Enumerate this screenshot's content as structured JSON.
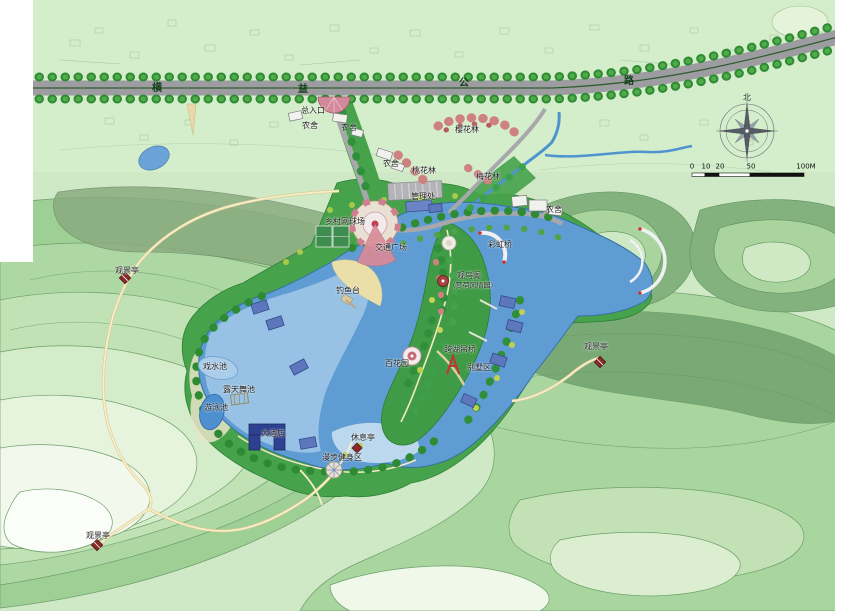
{
  "road": {
    "name_chars": [
      "横",
      "益",
      "公",
      "路"
    ]
  },
  "compass": {
    "north_label": "北"
  },
  "scale_bar": {
    "ticks": [
      "0",
      "10",
      "20",
      "50",
      "100M"
    ]
  },
  "labels": {
    "entrance": "总入口",
    "farmhouse_a": "农舍",
    "farmhouse_b": "农舍",
    "farmhouse_c": "农舍",
    "farmhouse_d": "农舍",
    "cherry_grove": "樱花林",
    "peach_grove": "桃花林",
    "plum_grove": "梅花林",
    "admin_office": "管理处",
    "tennis_court": "乡村网球场",
    "traffic_plaza": "交通广场",
    "rainbow_bridge": "彩虹桥",
    "fishing_platform": "钓鱼台",
    "bird_pavilion": "观鸟阁",
    "bird_pavilion_sub": "（赏荷风情园）",
    "flower_terrace": "百花园",
    "suspension_bridge": "跨湖吊桥",
    "villa_area": "别墅区",
    "viewing_pavilion_w": "观景亭",
    "viewing_pavilion_sw": "观景亭",
    "viewing_pavilion_e": "观景亭",
    "water_play_pool": "戏水池",
    "open_air_dance": "露天舞池",
    "swimming_pool": "游泳池",
    "hotel": "大酒店",
    "rest_pavilion": "休息亭",
    "fitness_trail": "漫步健身区"
  },
  "palette": {
    "base_green": "#cfe9c7",
    "hill_dark": "#79aa76",
    "ridge_olive": "#8aab80",
    "park_green": "#46a24b",
    "water_deep": "#5f9cd4",
    "water_light": "#9dc6e8",
    "road_gray": "#9d9da1",
    "path_cream": "#f7eeca",
    "pavilion_red": "#8a2b2b",
    "blossom_pink": "#cf8080",
    "roof_blue": "#5d77bd",
    "hotel_navy": "#2e4190"
  }
}
